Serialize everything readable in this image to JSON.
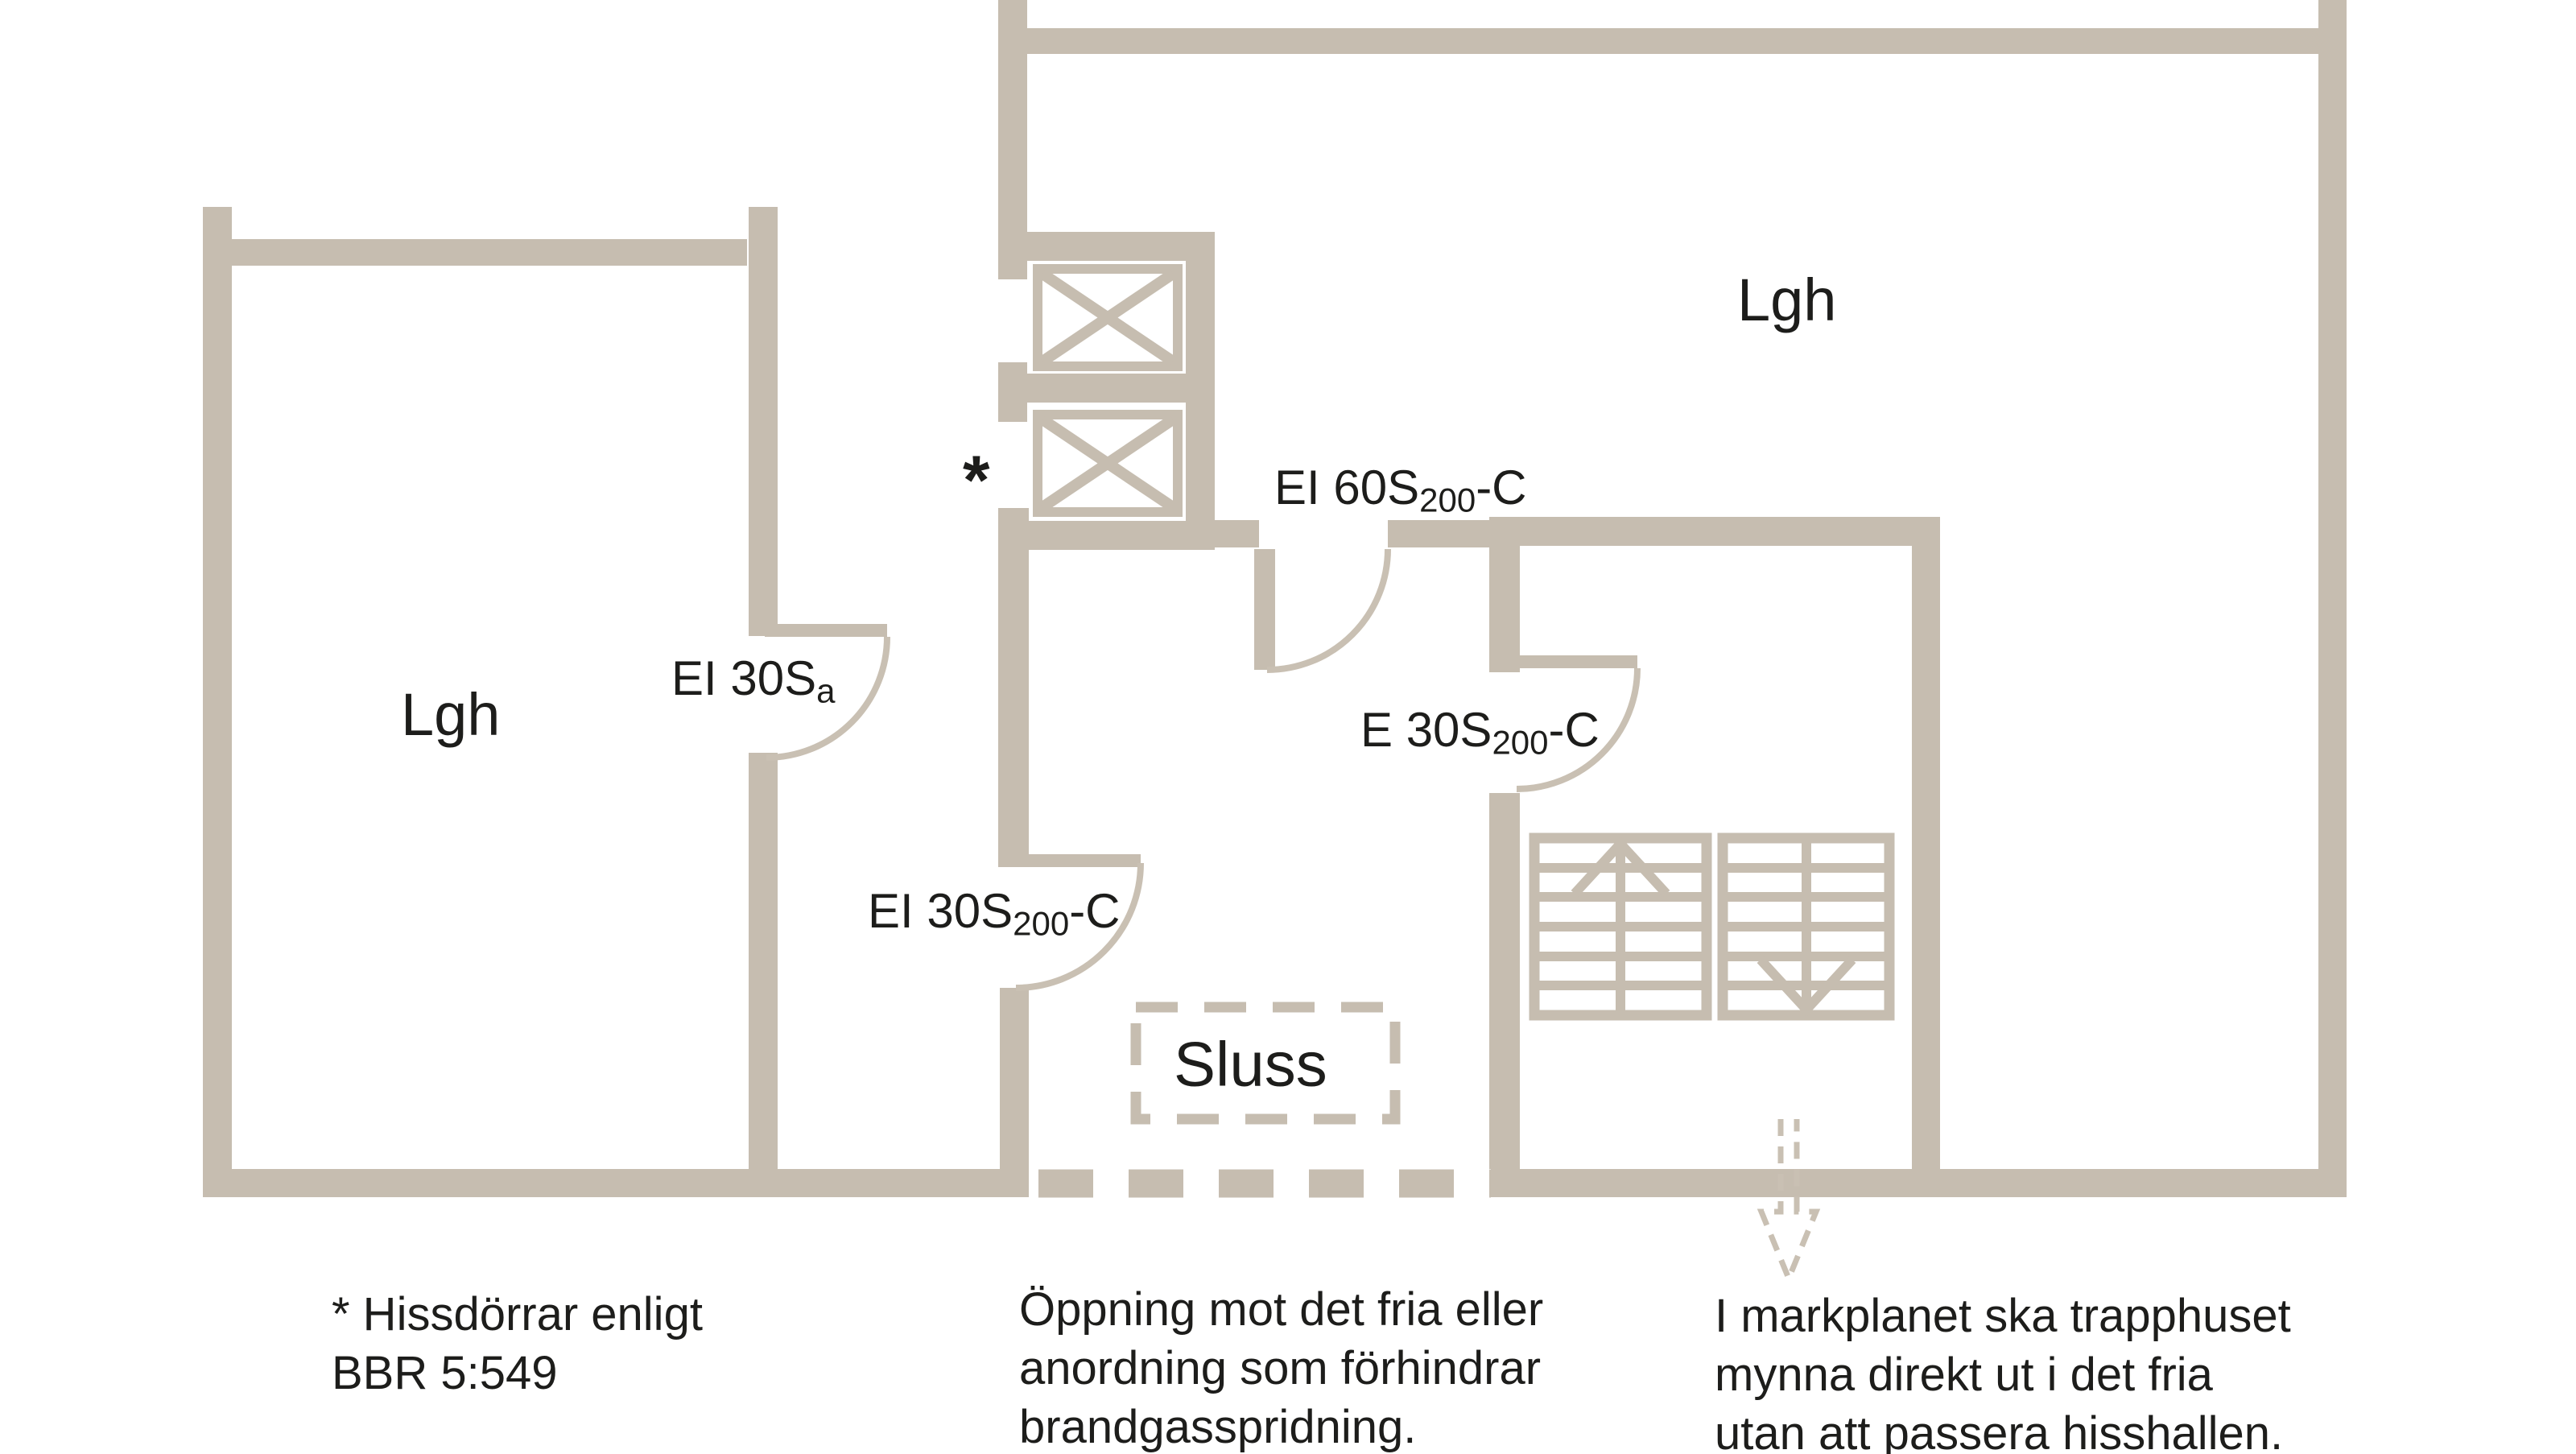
{
  "labels": {
    "apartment_left": "Lgh",
    "apartment_right": "Lgh",
    "sluss": "Sluss",
    "elevator_note_marker": "*"
  },
  "doors": {
    "ei30sa": {
      "name": "EI 30S",
      "sub": "a",
      "suffix": ""
    },
    "ei60s": {
      "name": "EI 60S",
      "sub": "200",
      "suffix": "-C"
    },
    "e30s": {
      "name": "E 30S",
      "sub": "200",
      "suffix": "-C"
    },
    "ei30s200": {
      "name": "EI 30S",
      "sub": "200",
      "suffix": "-C"
    }
  },
  "annotations": {
    "hissdorrar": [
      "* Hissdörrar enligt",
      "BBR 5:549"
    ],
    "oppning": [
      "Öppning mot det fria eller",
      "anordning som förhindrar",
      "brandgasspridning."
    ],
    "markplanet": [
      "I markplanet ska trapphuset",
      "mynna direkt ut i det fria",
      "utan att passera hisshallen."
    ]
  },
  "colors": {
    "wall": "#c6bdb0",
    "door_arc": "#c9c0b3",
    "text": "#1d1d1b",
    "background": "#ffffff"
  }
}
